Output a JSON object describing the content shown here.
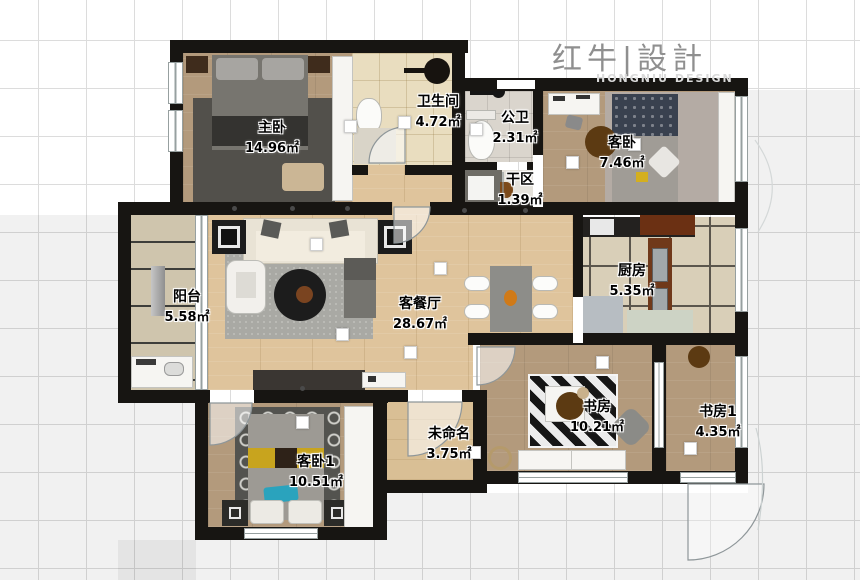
{
  "logo": {
    "brand": "红牛|設計",
    "watermark": "HONGNIU DESIGN"
  },
  "rooms": {
    "master": {
      "name": "主卧",
      "area": "14.96㎡"
    },
    "bathroom": {
      "name": "卫生间",
      "area": "4.72㎡"
    },
    "public_wc": {
      "name": "公卫",
      "area": "2.31㎡"
    },
    "guest_bedroom": {
      "name": "客卧",
      "area": "7.46㎡"
    },
    "dry_area": {
      "name": "干区",
      "area": "1.39㎡"
    },
    "balcony": {
      "name": "阳台",
      "area": "5.58㎡"
    },
    "living_dining": {
      "name": "客餐厅",
      "area": "28.67㎡"
    },
    "kitchen": {
      "name": "厨房",
      "area": "5.35㎡"
    },
    "study": {
      "name": "书房",
      "area": "10.21㎡"
    },
    "study_1": {
      "name": "书房1",
      "area": "4.35㎡"
    },
    "unnamed": {
      "name": "未命名",
      "area": "3.75㎡"
    },
    "guest_bedroom_1": {
      "name": "客卧1",
      "area": "10.51㎡"
    }
  },
  "palette": {
    "wall": "#171512",
    "wood_dark": "#b39a7c",
    "wood_light": "#dfc49c",
    "grid_line": "#dcdcdc",
    "logo_gray": "#8f8f8f",
    "label_text": "#000000"
  }
}
